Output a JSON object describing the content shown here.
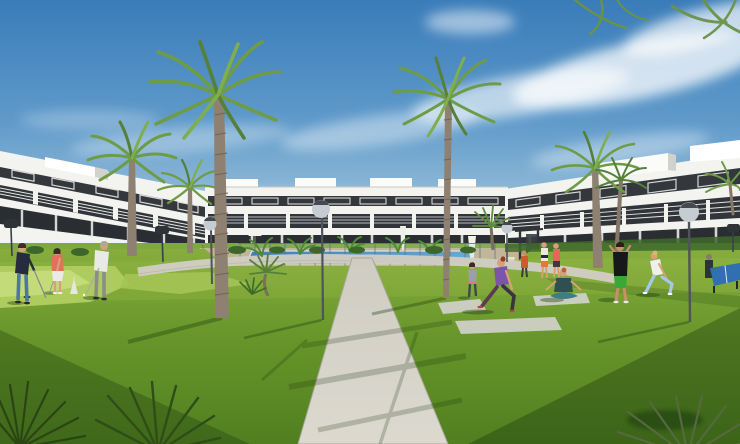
{
  "scene": {
    "description": "Sunny 3D architectural rendering of a modern white apartment complex with communal lawn, swimming pool, palm trees, mini-golf green and residents exercising",
    "image_width": 740,
    "image_height": 444,
    "elements": {
      "buildings": [
        "left apartment block",
        "center apartment block",
        "right apartment block"
      ],
      "amenities": [
        "swimming pool with glass fence",
        "central stone walkway",
        "curved side path",
        "mini golf putting green",
        "outdoor gym rig",
        "ping pong table",
        "yoga mats",
        "sun loungers",
        "white parasols",
        "globe street lamps",
        "dark street lamps"
      ],
      "vegetation": [
        "tall palm trees",
        "fan palms",
        "banana plants",
        "hedges",
        "lawn",
        "foreground palm fronds"
      ],
      "people": [
        "man in navy sweater playing mini golf",
        "woman in coral top playing mini golf",
        "man in white shirt putting on green",
        "woman in purple top lunging on yoga mat",
        "woman meditating cross-legged on mat",
        "woman walking on lawn",
        "man in black tee and green shorts stretching",
        "woman in white top and blue leggings stretching",
        "two women walking beside the pool",
        "person in orange at outdoor gym",
        "person at ping pong table"
      ]
    }
  },
  "colors": {
    "sky_top": "#3a7cb9",
    "sky_mid": "#5f9aca",
    "sky_low": "#9dc2da",
    "sky_horizon": "#c2d8e4",
    "cloud": "#ffffff",
    "building_white": "#f3f3f0",
    "building_shade": "#d2d2cd",
    "building_dark": "#34383c",
    "building_ground_dark": "#2a2e32",
    "window_frame": "#e9e9e6",
    "grass_back": "#7ea93c",
    "grass_light": "#86ad3e",
    "grass_mid": "#68962a",
    "grass_dark": "#517f20",
    "putting_green": "#aecb5e",
    "putting_green_light": "#c3dc79",
    "path": "#cfccc2",
    "path_light": "#dcd9cf",
    "path_edge": "#a9a69c",
    "pool_deck": "#c9b494",
    "pool_deep": "#2d71b4",
    "pool_light": "#5aa6d6",
    "fence_post": "#5f7076",
    "glass_tint": "#aac8d4",
    "palm_trunk": "#8e8172",
    "palm_trunk_dark": "#6f6455",
    "frond_dark": "#55803a",
    "frond_mid": "#6e9c46",
    "frond_light": "#7fae4f",
    "silhouette_palm": "#2a4514",
    "silhouette_palm_light": "#55693f",
    "lamp_dark": "#2e3338",
    "lamp_globe": "#c6cdd2",
    "shadow_green": "#1e3a0f",
    "skin": "#d8a078",
    "mat": "#d2d2ca",
    "golfer1_top": "#262b3f",
    "golfer1_jeans": "#4f74a8",
    "golfer_woman_top": "#e4705c",
    "golfer_woman_skirt": "#eceae6",
    "golfer2_shirt": "#e9e9e6",
    "golfer2_pants": "#8c8c8c",
    "lunge_top": "#7c55a8",
    "lunge_leggings": "#3a3340",
    "meditate_top": "#2f4f52",
    "meditate_pants": "#3f7d80",
    "man_tee": "#17181a",
    "man_shorts": "#3aa838",
    "stretch_top": "#efefec",
    "stretch_leggings": "#a6c8e8",
    "tabletennis_blue": "#2f6fb2"
  }
}
